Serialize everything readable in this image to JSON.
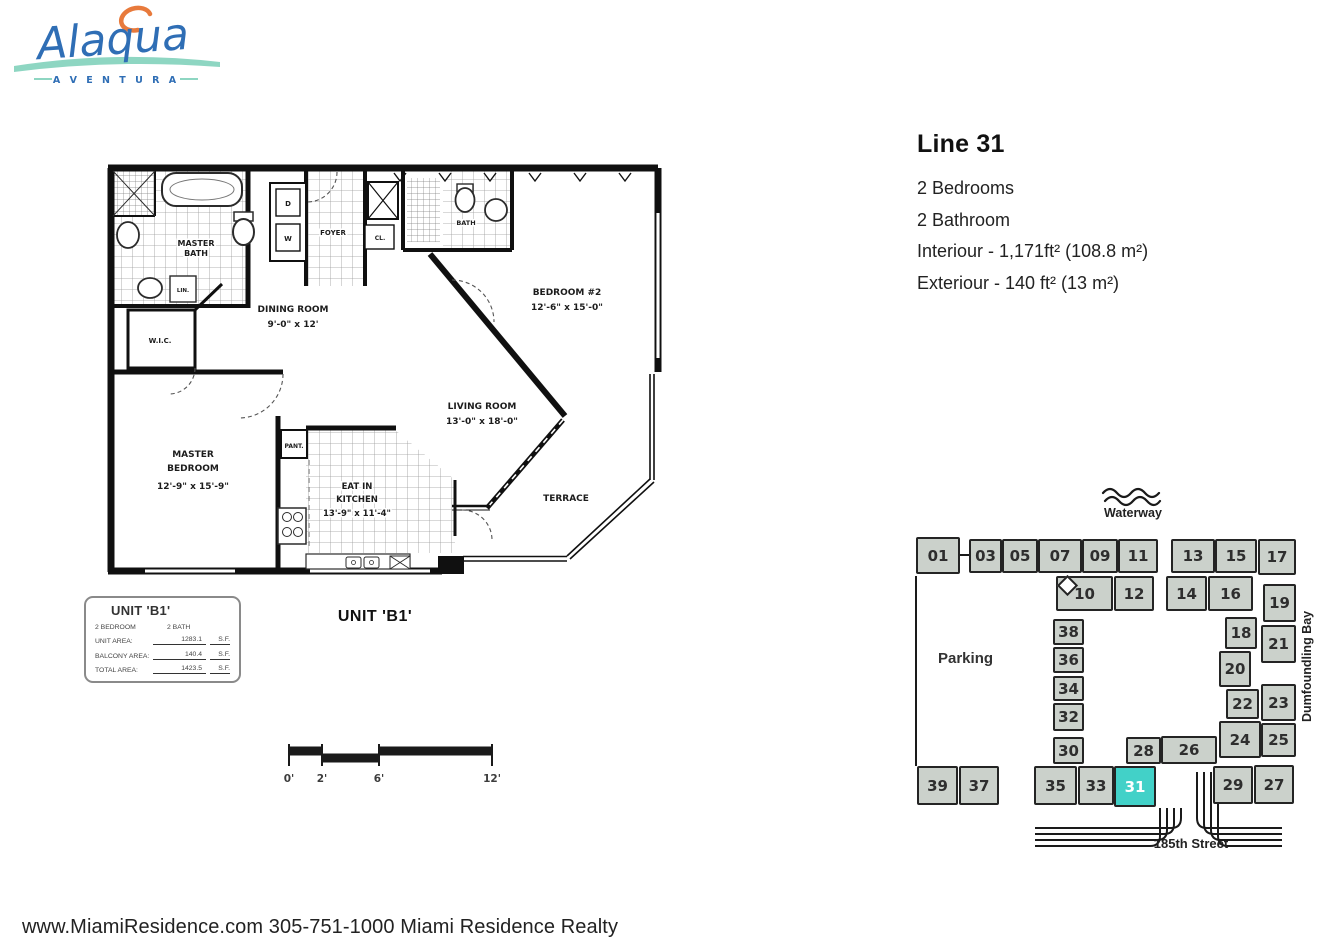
{
  "logo": {
    "name": "Alaqua",
    "subtitle": "A V E N T U R A"
  },
  "info": {
    "title": "Line 31",
    "lines": {
      "0": "2 Bedrooms",
      "1": "2 Bathroom",
      "2": "Interiour - 1,171ft² (108.8 m²)",
      "3": "Exteriour - 140 ft² (13 m²)"
    }
  },
  "floorplan": {
    "title": "UNIT 'B1'",
    "rooms": {
      "master_bath_1": "MASTER",
      "master_bath_2": "BATH",
      "wic": "W.I.C.",
      "lin": "LIN.",
      "dryer": "D",
      "washer": "W",
      "foyer": "FOYER",
      "cl": "CL.",
      "bath2": "BATH",
      "dining_name": "DINING ROOM",
      "dining_dims": "9'-0\" x 12'",
      "bedroom2_name": "BEDROOM #2",
      "bedroom2_dims": "12'-6\" x 15'-0\"",
      "living_name": "LIVING ROOM",
      "living_dims": "13'-0\" x 18'-0\"",
      "pantry": "PANT.",
      "master_name1": "MASTER",
      "master_name2": "BEDROOM",
      "master_dims": "12'-9\" x 15'-9\"",
      "kitchen_name1": "EAT IN",
      "kitchen_name2": "KITCHEN",
      "kitchen_dims": "13'-9\" x 11'-4\"",
      "terrace": "TERRACE"
    }
  },
  "legend": {
    "title": "UNIT 'B1'",
    "bedroom": "2 BEDROOM",
    "bath": "2 BATH",
    "rows": {
      "0": {
        "label": "UNIT AREA:",
        "value": "1283.1",
        "unit": "S.F."
      },
      "1": {
        "label": "BALCONY AREA:",
        "value": "140.4",
        "unit": "S.F."
      },
      "2": {
        "label": "TOTAL AREA:",
        "value": "1423.5",
        "unit": "S.F."
      }
    }
  },
  "scalebar": {
    "labels": {
      "0": "0'",
      "1": "2'",
      "2": "6'",
      "3": "12'"
    }
  },
  "sitemap": {
    "waterway": "Waterway",
    "parking": "Parking",
    "bay": "Dumfoundling Bay",
    "street": "185th Street",
    "block_color": "#cbd1cb",
    "highlight_color": "#42d1c8",
    "highlighted_unit": "31",
    "units": [
      {
        "label": "01",
        "x": 916,
        "y": 537,
        "w": 44,
        "h": 37
      },
      {
        "label": "03",
        "x": 969,
        "y": 539,
        "w": 33,
        "h": 34
      },
      {
        "label": "05",
        "x": 1002,
        "y": 539,
        "w": 36,
        "h": 34
      },
      {
        "label": "07",
        "x": 1038,
        "y": 539,
        "w": 44,
        "h": 34
      },
      {
        "label": "09",
        "x": 1082,
        "y": 539,
        "w": 36,
        "h": 34
      },
      {
        "label": "11",
        "x": 1118,
        "y": 539,
        "w": 40,
        "h": 34
      },
      {
        "label": "13",
        "x": 1171,
        "y": 539,
        "w": 44,
        "h": 34
      },
      {
        "label": "15",
        "x": 1215,
        "y": 539,
        "w": 42,
        "h": 34
      },
      {
        "label": "17",
        "x": 1258,
        "y": 539,
        "w": 38,
        "h": 36
      },
      {
        "label": "10",
        "x": 1056,
        "y": 576,
        "w": 57,
        "h": 35
      },
      {
        "label": "12",
        "x": 1114,
        "y": 576,
        "w": 40,
        "h": 35
      },
      {
        "label": "14",
        "x": 1166,
        "y": 576,
        "w": 41,
        "h": 35
      },
      {
        "label": "16",
        "x": 1208,
        "y": 576,
        "w": 45,
        "h": 35
      },
      {
        "label": "19",
        "x": 1263,
        "y": 584,
        "w": 33,
        "h": 38
      },
      {
        "label": "21",
        "x": 1261,
        "y": 625,
        "w": 35,
        "h": 38
      },
      {
        "label": "23",
        "x": 1261,
        "y": 684,
        "w": 35,
        "h": 37
      },
      {
        "label": "25",
        "x": 1261,
        "y": 723,
        "w": 35,
        "h": 34
      },
      {
        "label": "18",
        "x": 1225,
        "y": 617,
        "w": 32,
        "h": 32
      },
      {
        "label": "20",
        "x": 1219,
        "y": 651,
        "w": 32,
        "h": 36
      },
      {
        "label": "22",
        "x": 1226,
        "y": 689,
        "w": 33,
        "h": 30
      },
      {
        "label": "24",
        "x": 1219,
        "y": 721,
        "w": 42,
        "h": 37
      },
      {
        "label": "26",
        "x": 1161,
        "y": 736,
        "w": 56,
        "h": 28
      },
      {
        "label": "28",
        "x": 1126,
        "y": 737,
        "w": 35,
        "h": 27
      },
      {
        "label": "38",
        "x": 1053,
        "y": 619,
        "w": 31,
        "h": 26
      },
      {
        "label": "36",
        "x": 1053,
        "y": 647,
        "w": 31,
        "h": 26
      },
      {
        "label": "34",
        "x": 1053,
        "y": 676,
        "w": 31,
        "h": 25
      },
      {
        "label": "32",
        "x": 1053,
        "y": 703,
        "w": 31,
        "h": 28
      },
      {
        "label": "30",
        "x": 1053,
        "y": 737,
        "w": 31,
        "h": 27
      },
      {
        "label": "39",
        "x": 917,
        "y": 766,
        "w": 41,
        "h": 39
      },
      {
        "label": "37",
        "x": 959,
        "y": 766,
        "w": 40,
        "h": 39
      },
      {
        "label": "35",
        "x": 1034,
        "y": 766,
        "w": 43,
        "h": 39
      },
      {
        "label": "33",
        "x": 1078,
        "y": 766,
        "w": 36,
        "h": 39
      },
      {
        "label": "31",
        "x": 1114,
        "y": 766,
        "w": 42,
        "h": 41,
        "hl": true
      },
      {
        "label": "29",
        "x": 1213,
        "y": 766,
        "w": 40,
        "h": 38
      },
      {
        "label": "27",
        "x": 1254,
        "y": 765,
        "w": 40,
        "h": 39
      }
    ]
  },
  "footer": {
    "text": "www.MiamiResidence.com 305-751-1000 Miami Residence Realty"
  }
}
